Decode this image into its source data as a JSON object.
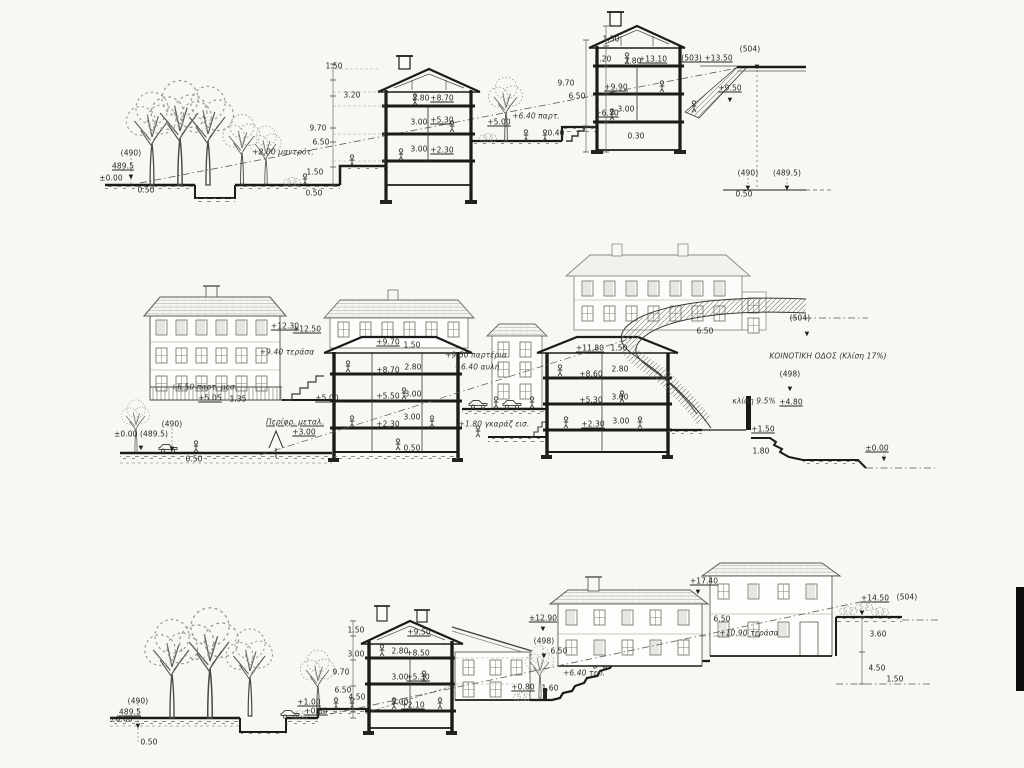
{
  "sheet": {
    "type": "architectural-site-sections",
    "paper_color": "#f8f7f4",
    "ink_color": "#1b1b19",
    "light_ink_color": "#777770",
    "section_names": [
      "upper-cross-section",
      "middle-elevation-section",
      "lower-cross-section"
    ]
  },
  "sections": [
    {
      "name": "upper-cross-section",
      "annotations": [
        {
          "t": "(490)",
          "x": 131,
          "y": 153
        },
        {
          "t": "489.5",
          "x": 123,
          "y": 166,
          "s": "u"
        },
        {
          "t": "±0.00",
          "x": 111,
          "y": 178
        },
        {
          "t": "▼",
          "x": 131,
          "y": 177,
          "s": "tri"
        },
        {
          "t": "0.50",
          "x": 146,
          "y": 190
        },
        {
          "t": "+2.00 μαντρότ.",
          "x": 283,
          "y": 152,
          "s": "hand"
        },
        {
          "t": "9.70",
          "x": 318,
          "y": 128
        },
        {
          "t": "6.50",
          "x": 321,
          "y": 142
        },
        {
          "t": "1.50",
          "x": 315,
          "y": 172
        },
        {
          "t": "0.50",
          "x": 314,
          "y": 193
        },
        {
          "t": "1.50",
          "x": 334,
          "y": 66
        },
        {
          "t": "3.20",
          "x": 352,
          "y": 95
        },
        {
          "t": "2.80",
          "x": 421,
          "y": 98
        },
        {
          "t": "+8.70",
          "x": 442,
          "y": 98,
          "s": "u"
        },
        {
          "t": "3.00",
          "x": 419,
          "y": 122
        },
        {
          "t": "+5.30",
          "x": 442,
          "y": 120,
          "s": "u"
        },
        {
          "t": "3.00",
          "x": 419,
          "y": 149
        },
        {
          "t": "+2.30",
          "x": 442,
          "y": 150,
          "s": "u"
        },
        {
          "t": "+5.00",
          "x": 499,
          "y": 122,
          "s": "u"
        },
        {
          "t": "+6.40 παρτ.",
          "x": 536,
          "y": 116,
          "s": "hand"
        },
        {
          "t": "0.40",
          "x": 556,
          "y": 133
        },
        {
          "t": "1.50",
          "x": 611,
          "y": 39
        },
        {
          "t": "3.20",
          "x": 603,
          "y": 59
        },
        {
          "t": "9.70",
          "x": 566,
          "y": 83
        },
        {
          "t": "6.50",
          "x": 577,
          "y": 96
        },
        {
          "t": "+13.10",
          "x": 653,
          "y": 59,
          "s": "u"
        },
        {
          "t": "2.80",
          "x": 633,
          "y": 61
        },
        {
          "t": "+9.90",
          "x": 616,
          "y": 87,
          "s": "u"
        },
        {
          "t": "3.00",
          "x": 626,
          "y": 109
        },
        {
          "t": "+6.70",
          "x": 607,
          "y": 113,
          "s": "u"
        },
        {
          "t": "0.30",
          "x": 636,
          "y": 136
        },
        {
          "t": "(503) +13.50",
          "x": 707,
          "y": 58,
          "s": "u"
        },
        {
          "t": "(504)",
          "x": 750,
          "y": 49
        },
        {
          "t": "▼",
          "x": 757,
          "y": 67,
          "s": "tri"
        },
        {
          "t": "+9.50",
          "x": 730,
          "y": 88,
          "s": "u"
        },
        {
          "t": "▼",
          "x": 730,
          "y": 100,
          "s": "tri"
        },
        {
          "t": "(490)",
          "x": 748,
          "y": 173
        },
        {
          "t": "▼",
          "x": 748,
          "y": 188,
          "s": "tri"
        },
        {
          "t": "(489.5)",
          "x": 787,
          "y": 173
        },
        {
          "t": "▼",
          "x": 787,
          "y": 188,
          "s": "tri"
        },
        {
          "t": "0.50",
          "x": 744,
          "y": 194
        }
      ]
    },
    {
      "name": "middle-elevation-section",
      "annotations": [
        {
          "t": "+12.30",
          "x": 285,
          "y": 326,
          "s": "u"
        },
        {
          "t": "+12.50",
          "x": 307,
          "y": 329,
          "s": "u"
        },
        {
          "t": "+9.40 τεράσα",
          "x": 287,
          "y": 352,
          "s": "hand"
        },
        {
          "t": "+6.50 παρτ. μεσ.",
          "x": 204,
          "y": 387,
          "s": "hand"
        },
        {
          "t": "+5.05",
          "x": 210,
          "y": 398,
          "s": "u"
        },
        {
          "t": "1.35",
          "x": 238,
          "y": 399
        },
        {
          "t": "+5.00",
          "x": 327,
          "y": 398,
          "s": "u"
        },
        {
          "t": "Περίφρ. μεταλ.",
          "x": 295,
          "y": 422,
          "s": "hand u"
        },
        {
          "t": "+3.00",
          "x": 304,
          "y": 432,
          "s": "u"
        },
        {
          "t": "(490)",
          "x": 172,
          "y": 424
        },
        {
          "t": "±0.00 (489.5)",
          "x": 141,
          "y": 434
        },
        {
          "t": "▼",
          "x": 172,
          "y": 449,
          "s": "tri"
        },
        {
          "t": "▼",
          "x": 141,
          "y": 448,
          "s": "tri"
        },
        {
          "t": "0.50",
          "x": 194,
          "y": 459
        },
        {
          "t": "+9.70",
          "x": 388,
          "y": 342,
          "s": "u"
        },
        {
          "t": "1.50",
          "x": 412,
          "y": 345
        },
        {
          "t": "+8.70",
          "x": 388,
          "y": 370,
          "s": "u"
        },
        {
          "t": "2.80",
          "x": 413,
          "y": 367
        },
        {
          "t": "+5.50",
          "x": 388,
          "y": 396,
          "s": "u"
        },
        {
          "t": "3.00",
          "x": 413,
          "y": 394
        },
        {
          "t": "+2.30",
          "x": 388,
          "y": 424,
          "s": "u"
        },
        {
          "t": "3.00",
          "x": 412,
          "y": 417
        },
        {
          "t": "0.50",
          "x": 412,
          "y": 448
        },
        {
          "t": "+9.50 παρτέρια",
          "x": 476,
          "y": 355,
          "s": "hand"
        },
        {
          "t": "+6.40 αυλή",
          "x": 477,
          "y": 367,
          "s": "hand"
        },
        {
          "t": "+1.80 γκαράζ εισ.",
          "x": 494,
          "y": 424,
          "s": "hand"
        },
        {
          "t": "+11.80",
          "x": 590,
          "y": 348,
          "s": "u"
        },
        {
          "t": "1.50",
          "x": 619,
          "y": 348
        },
        {
          "t": "+8.60",
          "x": 591,
          "y": 374,
          "s": "u"
        },
        {
          "t": "2.80",
          "x": 620,
          "y": 369
        },
        {
          "t": "+5.30",
          "x": 591,
          "y": 400,
          "s": "u"
        },
        {
          "t": "3.00",
          "x": 620,
          "y": 397
        },
        {
          "t": "+2.30",
          "x": 593,
          "y": 424,
          "s": "u"
        },
        {
          "t": "3.00",
          "x": 621,
          "y": 421
        },
        {
          "t": "6.50",
          "x": 705,
          "y": 331
        },
        {
          "t": "(504)",
          "x": 800,
          "y": 318
        },
        {
          "t": "▼",
          "x": 807,
          "y": 334,
          "s": "tri"
        },
        {
          "t": "ΚΟΙΝΟΤΙΚΗ ΟΔΟΣ (Κλίση 17%)",
          "x": 828,
          "y": 356,
          "s": "hand"
        },
        {
          "t": "(498)",
          "x": 790,
          "y": 374
        },
        {
          "t": "▼",
          "x": 790,
          "y": 389,
          "s": "tri"
        },
        {
          "t": "κλίση 9.5%",
          "x": 754,
          "y": 401,
          "s": "hand"
        },
        {
          "t": "+4.80",
          "x": 791,
          "y": 402,
          "s": "u"
        },
        {
          "t": "+1.50",
          "x": 763,
          "y": 429,
          "s": "u"
        },
        {
          "t": "1.80",
          "x": 761,
          "y": 451
        },
        {
          "t": "±0.00",
          "x": 877,
          "y": 448,
          "s": "u"
        },
        {
          "t": "▼",
          "x": 884,
          "y": 459,
          "s": "tri"
        }
      ]
    },
    {
      "name": "lower-cross-section",
      "annotations": [
        {
          "t": "(490)",
          "x": 138,
          "y": 701
        },
        {
          "t": "489.5",
          "x": 130,
          "y": 712,
          "s": "u"
        },
        {
          "t": "±0.00",
          "x": 121,
          "y": 719
        },
        {
          "t": "▼",
          "x": 138,
          "y": 726,
          "s": "tri"
        },
        {
          "t": "0.50",
          "x": 149,
          "y": 742
        },
        {
          "t": "+1.00",
          "x": 309,
          "y": 702,
          "s": "u"
        },
        {
          "t": "+0.80",
          "x": 316,
          "y": 711,
          "s": "u"
        },
        {
          "t": "1.50",
          "x": 356,
          "y": 630
        },
        {
          "t": "3.00",
          "x": 356,
          "y": 654
        },
        {
          "t": "9.70",
          "x": 341,
          "y": 672
        },
        {
          "t": "6.50",
          "x": 343,
          "y": 690
        },
        {
          "t": "4.50",
          "x": 357,
          "y": 697
        },
        {
          "t": "+9.50",
          "x": 419,
          "y": 632,
          "s": "u"
        },
        {
          "t": "2.80",
          "x": 400,
          "y": 651
        },
        {
          "t": "+8.50",
          "x": 418,
          "y": 653,
          "s": "u"
        },
        {
          "t": "3.00",
          "x": 400,
          "y": 677
        },
        {
          "t": "+5.30",
          "x": 418,
          "y": 677,
          "s": "u"
        },
        {
          "t": "3.00",
          "x": 400,
          "y": 702
        },
        {
          "t": "+2.10",
          "x": 413,
          "y": 705,
          "s": "u"
        },
        {
          "t": "+0.80",
          "x": 523,
          "y": 687,
          "s": "u"
        },
        {
          "t": "1.60",
          "x": 550,
          "y": 688
        },
        {
          "t": "+12.90",
          "x": 543,
          "y": 618,
          "s": "u"
        },
        {
          "t": "▼",
          "x": 543,
          "y": 629,
          "s": "tri"
        },
        {
          "t": "(498)",
          "x": 544,
          "y": 641
        },
        {
          "t": "▼",
          "x": 544,
          "y": 656,
          "s": "tri"
        },
        {
          "t": "6.50",
          "x": 559,
          "y": 651
        },
        {
          "t": "+6.40 τερ.",
          "x": 584,
          "y": 673,
          "s": "hand"
        },
        {
          "t": "+10.90 τεράσα",
          "x": 749,
          "y": 633,
          "s": "hand"
        },
        {
          "t": "6.50",
          "x": 722,
          "y": 619
        },
        {
          "t": "+17.40",
          "x": 704,
          "y": 581,
          "s": "u"
        },
        {
          "t": "▼",
          "x": 698,
          "y": 592,
          "s": "tri"
        },
        {
          "t": "+14.50",
          "x": 875,
          "y": 598,
          "s": "u"
        },
        {
          "t": "(504)",
          "x": 907,
          "y": 597
        },
        {
          "t": "▼",
          "x": 862,
          "y": 613,
          "s": "tri"
        },
        {
          "t": "3.60",
          "x": 878,
          "y": 634
        },
        {
          "t": "4.50",
          "x": 877,
          "y": 668
        },
        {
          "t": "1.50",
          "x": 895,
          "y": 679
        }
      ]
    }
  ]
}
